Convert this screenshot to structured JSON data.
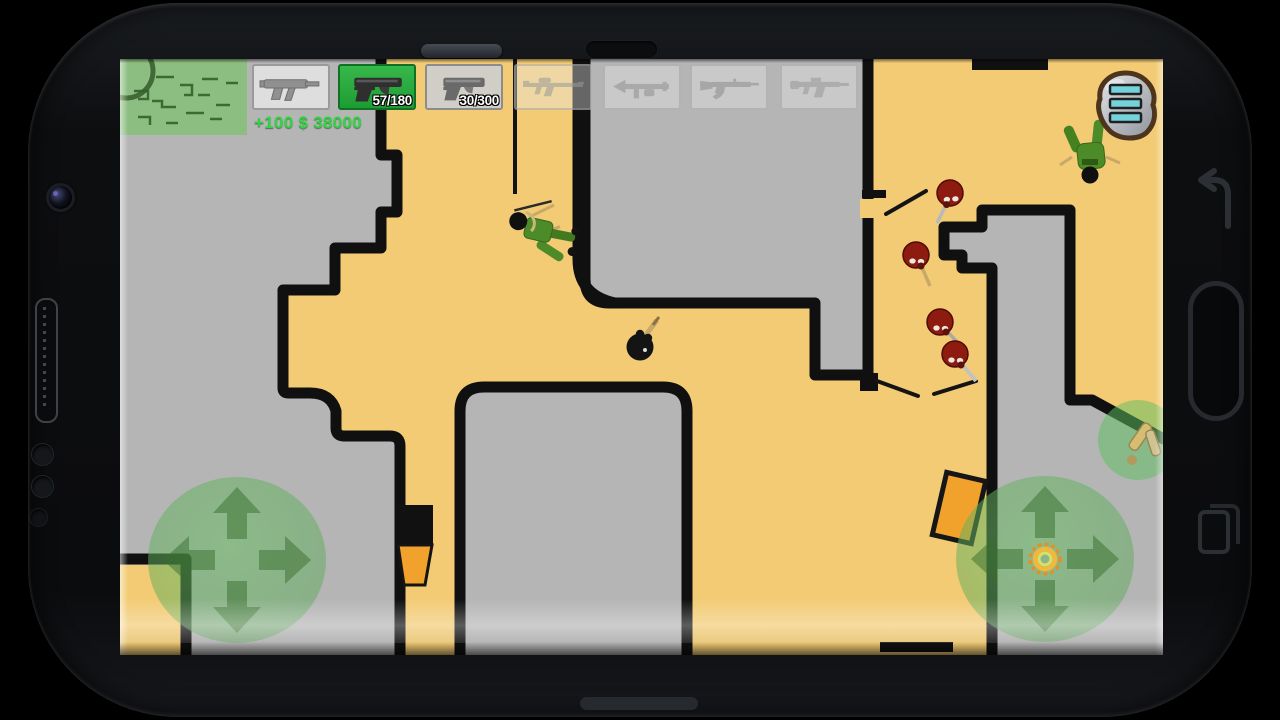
{
  "app": {
    "title": "Stickman top-down shooter (phone mockup)",
    "device": "smartphone-landscape"
  },
  "hud": {
    "money_text": "+100 $ 38000",
    "minimap_label": "minimap-overlay",
    "menu_icon": "hamburger-menu-stone-button",
    "weapon_slots": [
      {
        "name": "smg-mp5",
        "ammo": "",
        "state": "available"
      },
      {
        "name": "pistol-long-slide",
        "ammo": "57/180",
        "state": "selected"
      },
      {
        "name": "pistol-compact",
        "ammo": "30/300",
        "state": "available"
      },
      {
        "name": "rifle-m16",
        "ammo": "",
        "state": "locked"
      },
      {
        "name": "rpg-launcher",
        "ammo": "",
        "state": "locked"
      },
      {
        "name": "rifle-ak47",
        "ammo": "",
        "state": "locked"
      },
      {
        "name": "carbine",
        "ammo": "",
        "state": "locked"
      }
    ]
  },
  "game": {
    "player": "black-stickman-with-gun",
    "red_enemy_count": 4,
    "dead_green_soldier_count": 2,
    "pickups": [
      "ammo-pack-green-circle"
    ],
    "doors": [
      "orange-open-door-right",
      "orange-open-door-bottom-corridor"
    ],
    "muzzle_flash": "orange-ring-on-right-joystick"
  },
  "controls": {
    "left_joystick": "move-pad-four-arrows",
    "right_joystick": "aim-fire-pad-four-arrows"
  },
  "device_frame": {
    "left_side": [
      "camera-lens",
      "speaker-grille",
      "sensor-dot",
      "sensor-dot",
      "sensor-dot"
    ],
    "right_side": [
      "back-key",
      "home-key",
      "recents-key"
    ],
    "top": [
      "earpiece-speaker",
      "front-camera-slot"
    ],
    "bottom": [
      "home-bar"
    ]
  },
  "colors": {
    "floor_yellow": "#f2cb74",
    "floor_gray": "#b5b5b6",
    "wall_black": "#101010",
    "hud_green": "#2aae3e",
    "money_green": "#35d445",
    "enemy_red": "#8e1b10",
    "soldier_green": "#4c8b27",
    "door_orange": "#f0a22c",
    "joystick_green": "rgba(95,175,90,0.5)"
  }
}
